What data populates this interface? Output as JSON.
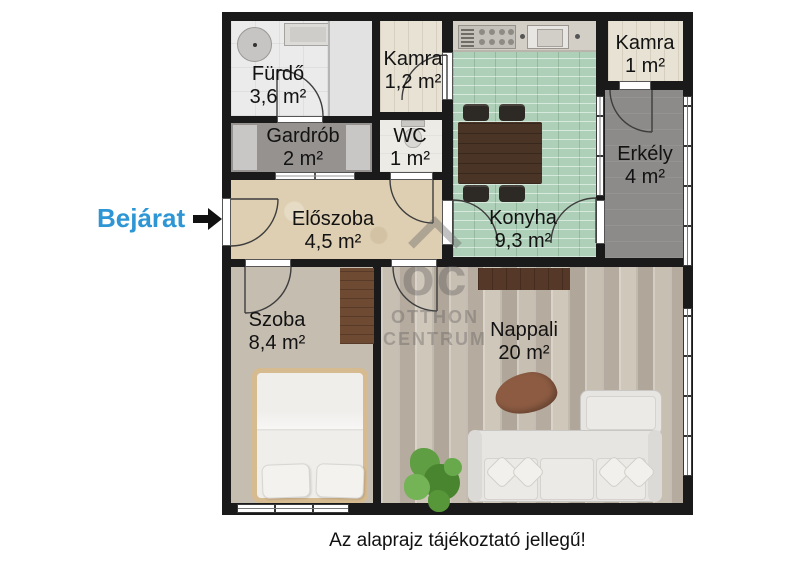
{
  "plan": {
    "rooms": [
      {
        "name": "Fürdő",
        "area": "3,6 m²"
      },
      {
        "name": "Kamra",
        "area": "1,2 m²"
      },
      {
        "name": "Gardrób",
        "area": "2 m²"
      },
      {
        "name": "WC",
        "area": "1 m²"
      },
      {
        "name": "Előszoba",
        "area": "4,5 m²"
      },
      {
        "name": "Konyha",
        "area": "9,3 m²"
      },
      {
        "name": "Kamra",
        "area": "1 m²"
      },
      {
        "name": "Erkély",
        "area": "4 m²"
      },
      {
        "name": "Szoba",
        "area": "8,4 m²"
      },
      {
        "name": "Nappali",
        "area": "20 m²"
      }
    ],
    "entrance_label": "Bejárat",
    "watermark": {
      "logo": "oc",
      "line1": "OTTHON",
      "line2": "CENTRUM"
    },
    "disclaimer": "Az alaprajz tájékoztató jellegű!"
  },
  "colors": {
    "entrance_blue": "#2E96D4",
    "wall": "#1a1a1a",
    "kitchen_tile": "#afd0b8",
    "hall_floor": "#decfb2",
    "wood_floor": "#c6bdb1",
    "balcony_gray": "#8d8b89"
  }
}
